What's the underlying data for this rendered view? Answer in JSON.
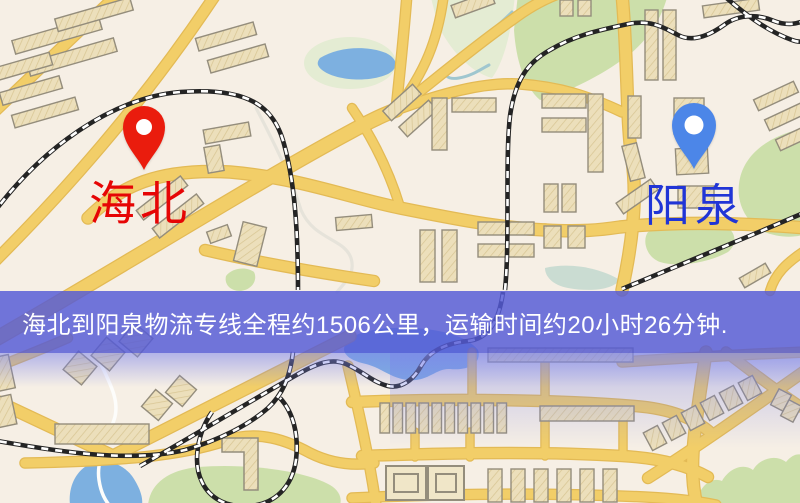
{
  "banner": {
    "text": "海北到阳泉物流专线全程约1506公里，运输时间约20小时26分钟.",
    "background": "rgba(84,90,214,0.83)",
    "text_color": "#ffffff"
  },
  "route_info": {
    "origin": "海北",
    "destination": "阳泉",
    "distance_km": "1506",
    "duration": "20小时26分钟"
  },
  "map": {
    "markers": [
      {
        "id": "origin",
        "label": "海北",
        "pin_color": "#ea1c0d",
        "label_color": "#e60505",
        "pin_icon": "map-pin-icon"
      },
      {
        "id": "destination",
        "label": "阳泉",
        "pin_color": "#4c86e8",
        "label_color": "#2135d6",
        "pin_icon": "map-pin-icon"
      }
    ]
  },
  "colors": {
    "map-bg": "#f6efe5",
    "road": "#f2ce68",
    "road-casing": "#e3ba55",
    "water": "#7db0e0",
    "green": "#ccdfaa",
    "green-light": "#e4ecd3",
    "rail-dark": "#242424",
    "rail-light": "#ffffff",
    "building": "#ecdfbb",
    "building-line": "#d8c694",
    "building-stroke": "#948d7c",
    "stream-gray": "#e6e3da",
    "stream-white": "#fdfdfb",
    "stream-teal": "#9fc6cf",
    "banner-bg": "rgba(84,90,214,0.83)",
    "banner-text": "#ffffff",
    "pin-red": "#ea1c0d",
    "pin-blue": "#4c86e8",
    "label-red": "#e60505",
    "label-blue": "#2135d6"
  }
}
